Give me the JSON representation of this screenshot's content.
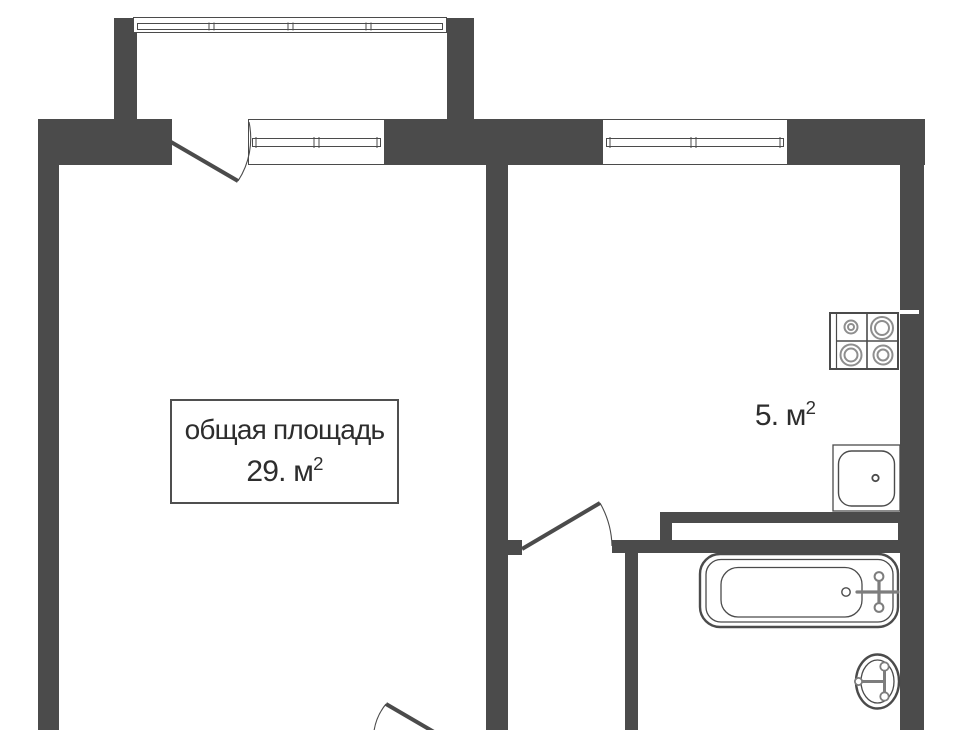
{
  "title": "apartment floor plan",
  "colors": {
    "background": "#ffffff",
    "wall": "#4b4b4b",
    "outline": "#4b4b4b",
    "fixture_light": "#8e8e8e",
    "faucet": "#7d7d7d",
    "text": "#2d2d2d",
    "label_border": "#4f4f4f"
  },
  "labels": {
    "living_room": {
      "line1": "общая площадь",
      "area": "29. м",
      "area_sup": "2"
    },
    "kitchen": {
      "area": "5. м",
      "area_sup": "2"
    }
  },
  "rooms": [
    {
      "name": "living-room",
      "label": "общая площадь 29. м²"
    },
    {
      "name": "kitchen",
      "label": "5. м²"
    },
    {
      "name": "bathroom",
      "label": ""
    },
    {
      "name": "hallway",
      "label": ""
    },
    {
      "name": "balcony",
      "label": ""
    }
  ],
  "fixtures": [
    {
      "icon": "stove-icon",
      "room": "kitchen"
    },
    {
      "icon": "kitchen-sink-icon",
      "room": "kitchen"
    },
    {
      "icon": "bathtub-icon",
      "room": "bathroom"
    },
    {
      "icon": "washbasin-icon",
      "room": "bathroom"
    }
  ],
  "openings": [
    {
      "icon": "balcony-window-icon",
      "type": "window-band"
    },
    {
      "icon": "balcony-door-icon",
      "type": "door-swing"
    },
    {
      "icon": "living-room-window-icon",
      "type": "window"
    },
    {
      "icon": "kitchen-window-icon",
      "type": "window"
    },
    {
      "icon": "hall-kitchen-door-icon",
      "type": "door-swing"
    },
    {
      "icon": "entry-door-icon",
      "type": "door-swing"
    }
  ]
}
